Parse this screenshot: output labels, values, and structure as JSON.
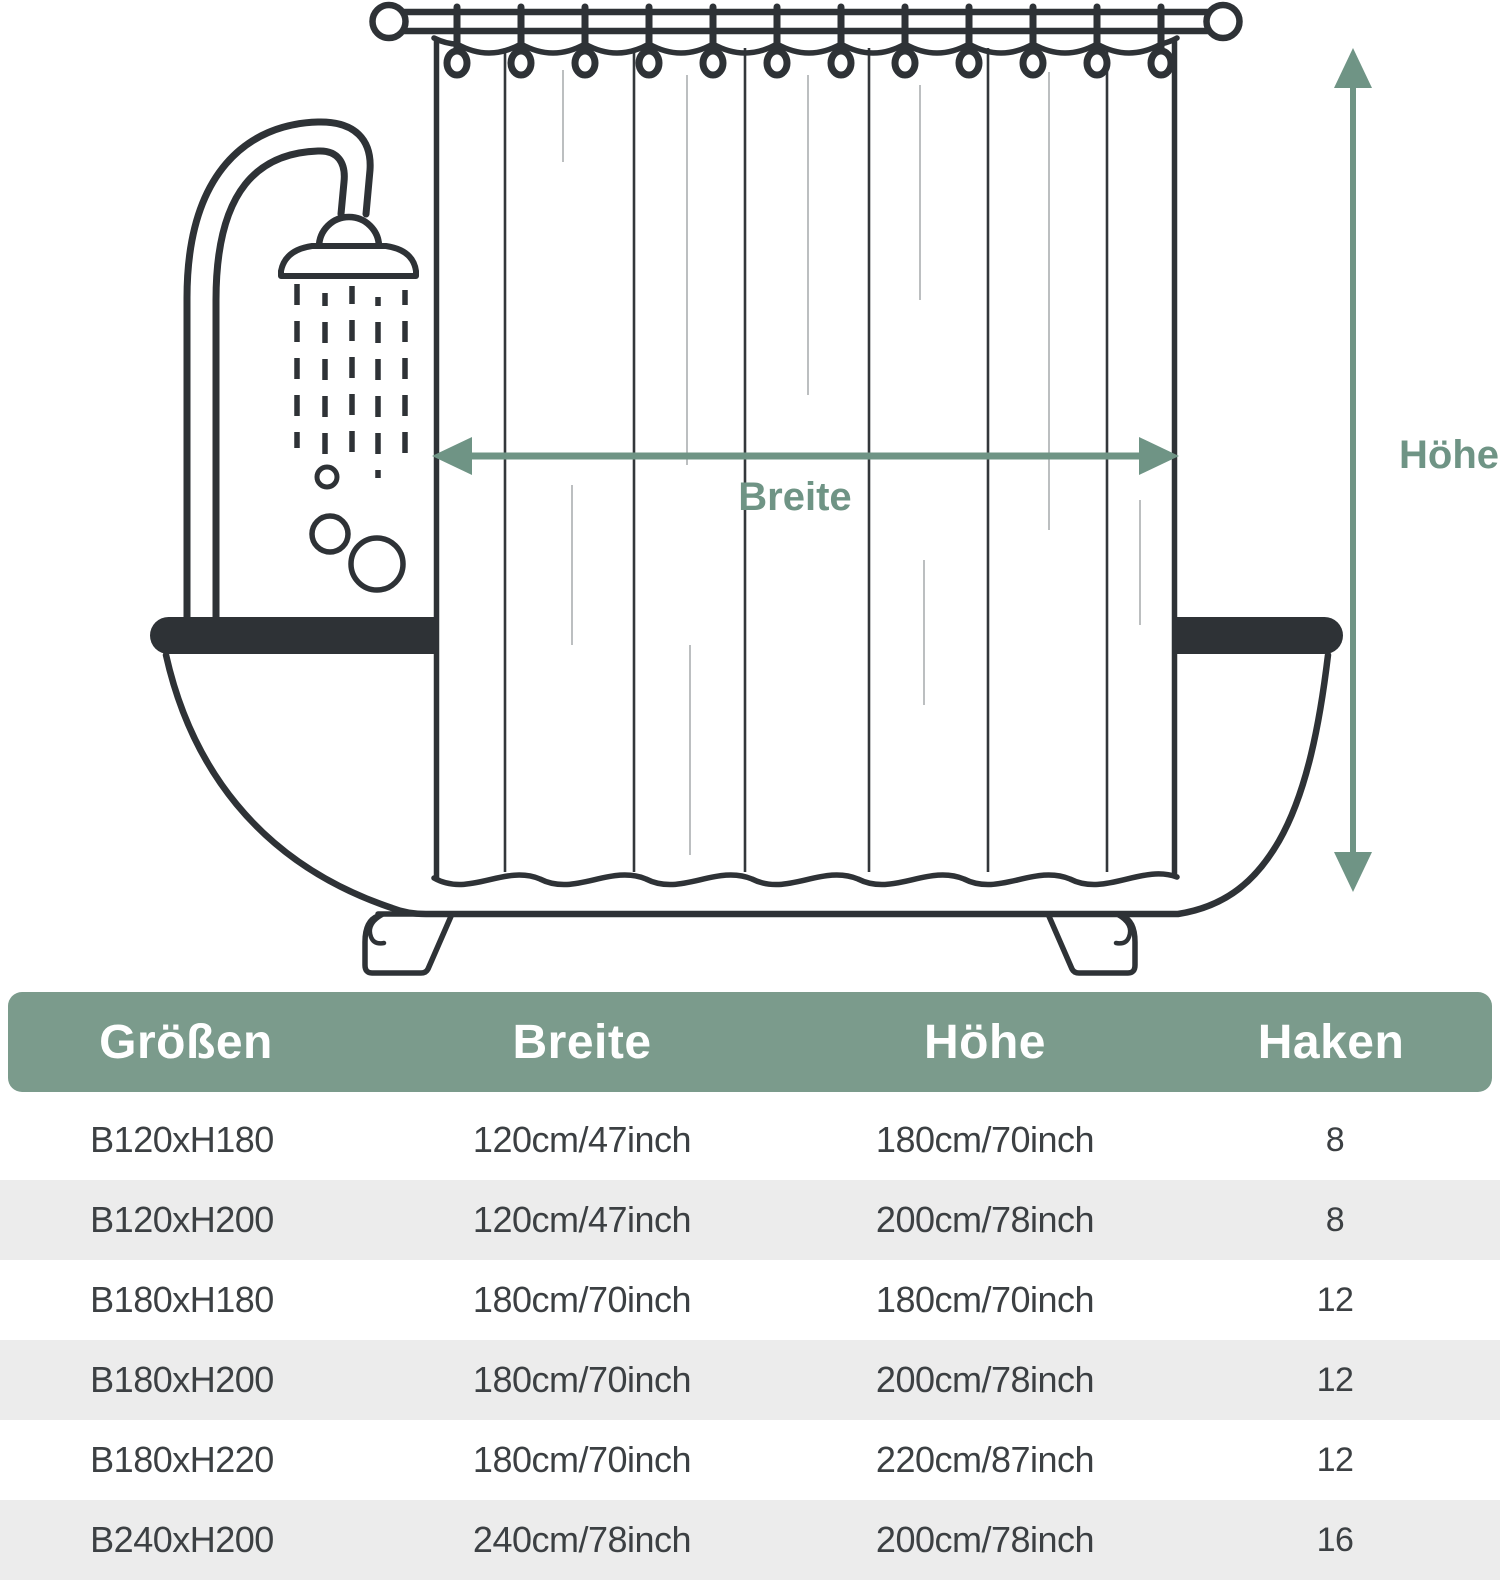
{
  "diagram": {
    "width_label": "Breite",
    "height_label": "Höhe",
    "hook_count": 12,
    "colors": {
      "accent_green": "#6f9485",
      "header_green": "#7b9b8c",
      "line_dark": "#2e3236",
      "fold_light": "#b5b8ba",
      "row_alt_gray": "#ececec",
      "table_text": "#3c4043"
    }
  },
  "table": {
    "headers": [
      "Größen",
      "Breite",
      "Höhe",
      "Haken"
    ],
    "rows": [
      [
        "B120xH180",
        "120cm/47inch",
        "180cm/70inch",
        "8"
      ],
      [
        "B120xH200",
        "120cm/47inch",
        "200cm/78inch",
        "8"
      ],
      [
        "B180xH180",
        "180cm/70inch",
        "180cm/70inch",
        "12"
      ],
      [
        "B180xH200",
        "180cm/70inch",
        "200cm/78inch",
        "12"
      ],
      [
        "B180xH220",
        "180cm/70inch",
        "220cm/87inch",
        "12"
      ],
      [
        "B240xH200",
        "240cm/78inch",
        "200cm/78inch",
        "16"
      ]
    ]
  }
}
